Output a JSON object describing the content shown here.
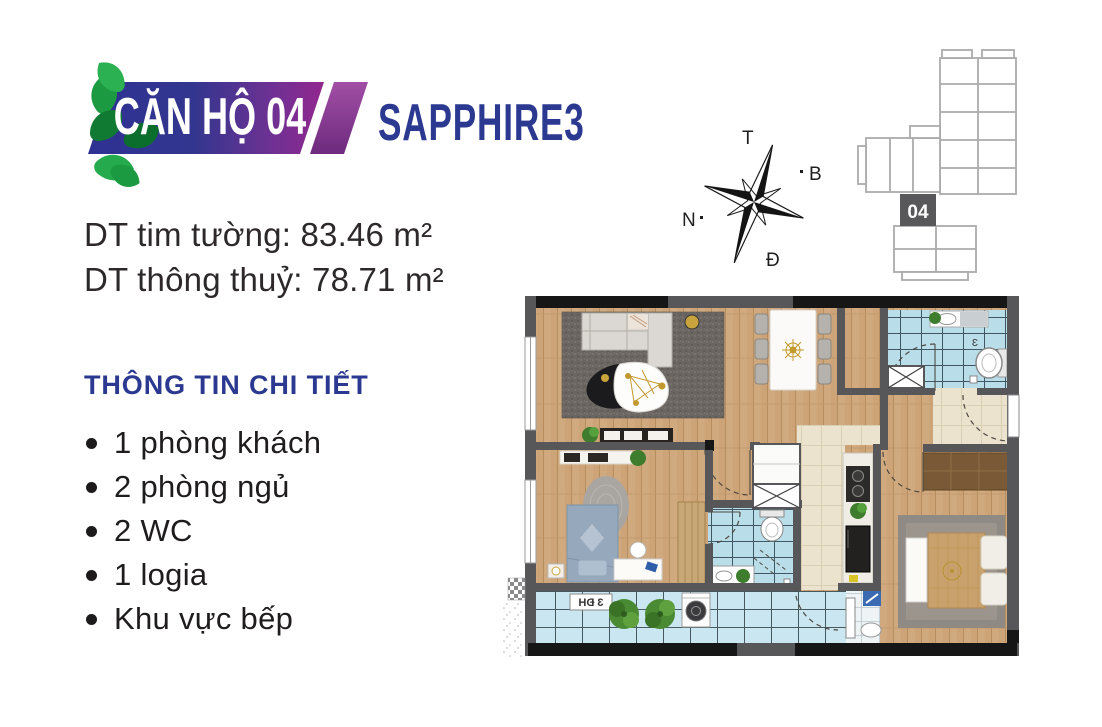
{
  "banner": {
    "unit_label": "CĂN HỘ 04",
    "project_label": "SAPPHIRE3"
  },
  "areas": {
    "line1": "DT tim tường: 83.46 m²",
    "line2": "DT thông thuỷ: 78.71 m²"
  },
  "details": {
    "heading": "THÔNG TIN CHI TIẾT",
    "items": [
      "1 phòng khách",
      "2 phòng ngủ",
      "2 WC",
      "1 logia",
      "Khu vực bếp"
    ]
  },
  "compass": {
    "top": "T",
    "right": "B",
    "left": "N",
    "bottom": "Đ"
  },
  "keyplan": {
    "unit_number": "04"
  },
  "floorplan": {
    "logia_sign": "3 ĐH",
    "wc_mark": "Ɛ"
  },
  "colors": {
    "navy": "#2b3990",
    "banner_blue": "#2e3192",
    "banner_purple": "#92278f",
    "leaf_green": "#1c9a41",
    "wall_gray": "#57575a",
    "wood": "#cda478",
    "tile_blue": "#badee9",
    "tile_beige": "#ebe3cd",
    "text_dark": "#2d292a"
  }
}
